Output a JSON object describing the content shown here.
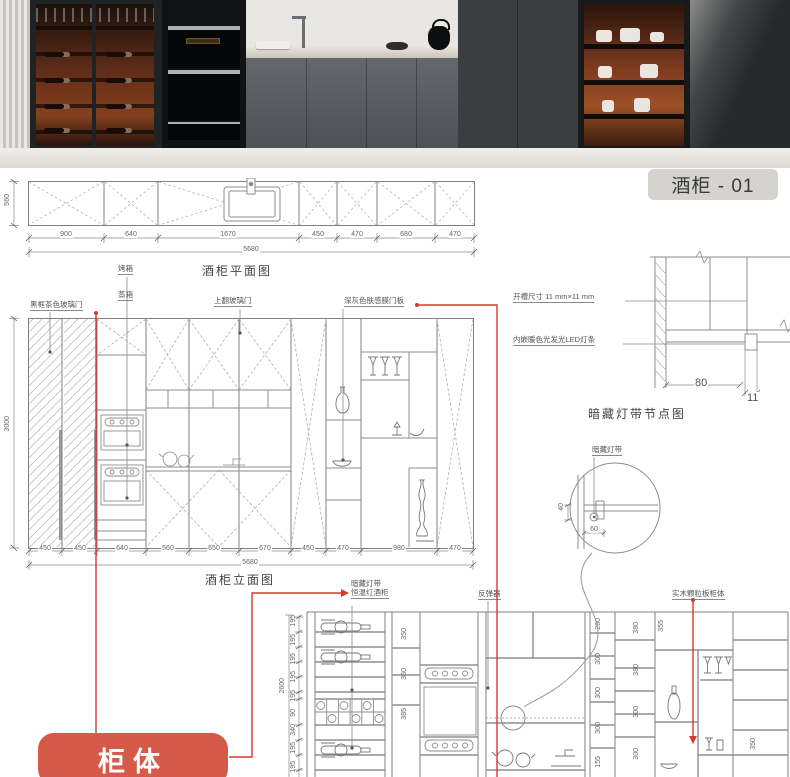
{
  "photo": {
    "badge": "酒柜 - 01"
  },
  "plan": {
    "title": "酒柜平面图",
    "depth": "560",
    "dims": [
      "900",
      "640",
      "1670",
      "450",
      "470",
      "680",
      "470"
    ],
    "total": "5680"
  },
  "elev": {
    "title": "酒柜立面图",
    "height": "3000",
    "dims": [
      "450",
      "450",
      "640",
      "560",
      "650",
      "670",
      "450",
      "470",
      "980",
      "470"
    ],
    "total": "5680",
    "labels": {
      "glass_door": "黑框茶色玻璃门",
      "oven": "烤箱",
      "steam": "蒸箱",
      "flip": "上翻玻璃门",
      "panel": "深灰色肤感膜门板"
    }
  },
  "detail": {
    "title": "暗藏灯带节点图",
    "slot": "开槽尺寸 11 mm×11 mm",
    "led": "内嵌暖色光发光LED灯条",
    "d80": "80",
    "d11": "11"
  },
  "cdetail": {
    "label": "暗藏灯带",
    "d40": "40",
    "d60": "60"
  },
  "bottom": {
    "labels": {
      "hidden": "暗藏灯带",
      "fridge": "恒温红酒柜",
      "rebound": "反弹器",
      "body": "实木颗粒板柜体"
    },
    "height": "2600",
    "left_dims": [
      "195",
      "195",
      "195",
      "195",
      "195",
      "90",
      "340",
      "195",
      "195"
    ],
    "colA": [
      "350",
      "350",
      "385"
    ],
    "colB": [
      "280",
      "300",
      "300",
      "300",
      "155"
    ],
    "colC": [
      "380",
      "380",
      "300",
      "300"
    ],
    "d355": "355",
    "d350": "350"
  },
  "tag": {
    "label": "柜体"
  },
  "colors": {
    "red_accent": "#d23c2a",
    "tag_bg": "#d55a4a",
    "badge_bg": "#d5d3d0",
    "cad_line": "#8a8a8a",
    "warm_glow": "#7c3a1f"
  }
}
